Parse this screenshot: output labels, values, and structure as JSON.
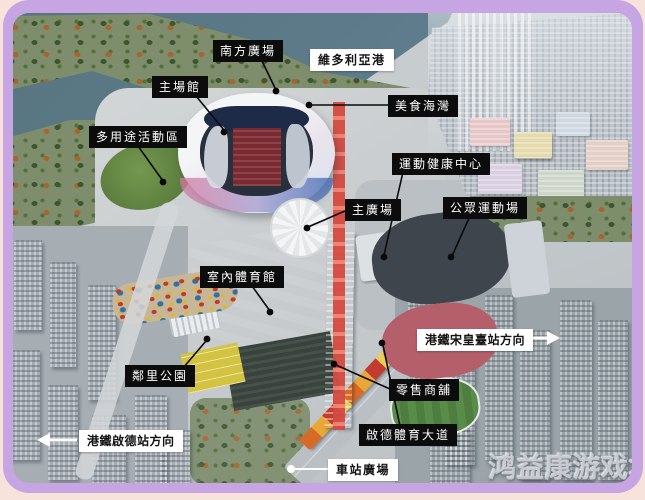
{
  "colors": {
    "frame_purple": "#c7a4e2",
    "page_pink": "#f8e3dc",
    "label_dark_bg": "#0c0c0c",
    "label_dark_text": "#ffffff",
    "label_light_bg": "#ffffff",
    "label_light_text": "#131313",
    "water": "#5d7b8a"
  },
  "annotations": {
    "south_plaza": {
      "text": "南方廣場",
      "style": "dark"
    },
    "victoria_harbour": {
      "text": "維多利亞港",
      "style": "light"
    },
    "main_stadium": {
      "text": "主場館",
      "style": "dark"
    },
    "food_bay": {
      "text": "美食海灣",
      "style": "dark"
    },
    "multi_purpose_zone": {
      "text": "多用途活動區",
      "style": "dark"
    },
    "sports_health_center": {
      "text": "運動健康中心",
      "style": "dark"
    },
    "main_plaza": {
      "text": "主廣場",
      "style": "dark"
    },
    "public_sports_ground": {
      "text": "公眾運動場",
      "style": "dark"
    },
    "indoor_sports_hall": {
      "text": "室內體育館",
      "style": "dark"
    },
    "mtr_sung_wong_toi_direction": {
      "text": "港鐵宋皇臺站方向",
      "style": "light",
      "arrow": "right"
    },
    "neighbourhood_park": {
      "text": "鄰里公園",
      "style": "dark"
    },
    "retail_shops": {
      "text": "零售商舖",
      "style": "dark"
    },
    "kai_tak_sports_avenue": {
      "text": "啟德體育大道",
      "style": "dark"
    },
    "mtr_kai_tak_direction": {
      "text": "港鐵啟德站方向",
      "style": "light",
      "arrow": "left"
    },
    "station_plaza": {
      "text": "車站廣場",
      "style": "light"
    }
  },
  "watermark": {
    "text": "鸿益康游戏坊"
  }
}
